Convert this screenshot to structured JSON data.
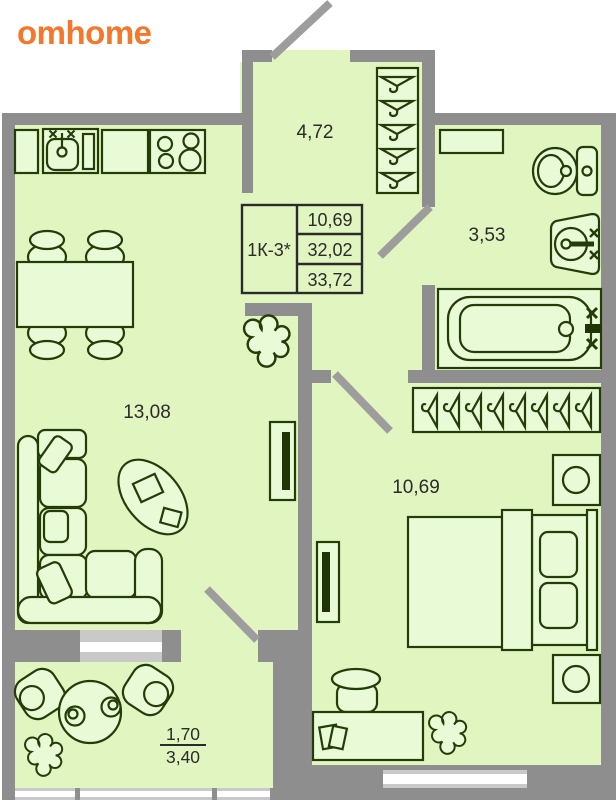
{
  "brand": {
    "logo_text": "omhome",
    "logo_color": "#f5772b"
  },
  "info_table": {
    "unit_type": "1К-3*",
    "row1": "10,69",
    "row2": "32,02",
    "row3": "33,72"
  },
  "labels": {
    "hallway_area": "4,72",
    "bathroom_area": "3,53",
    "living_area": "13,08",
    "bedroom_area": "10,69",
    "balcony_area_upper": "1,70",
    "balcony_area_lower": "3,40"
  },
  "colors": {
    "floor": "#e1f5c1",
    "wall": "#8e8e8e",
    "furniture_outline": "#233c08",
    "window_frame": "#c9c9c9",
    "window_glass": "#ffffff",
    "brand_accent": "#f5772b"
  }
}
